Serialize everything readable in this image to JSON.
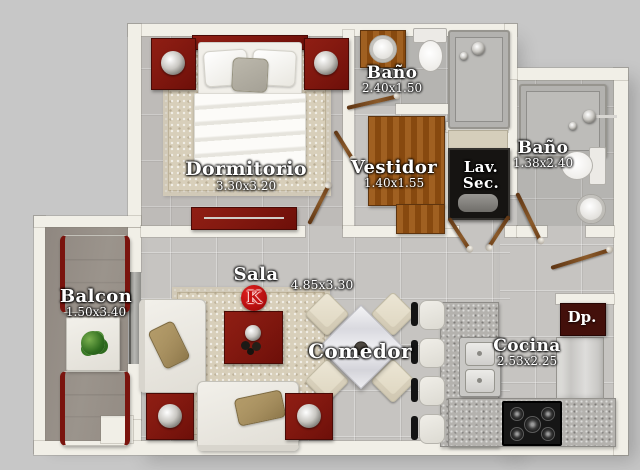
{
  "logo": {
    "letter": "K"
  },
  "rooms": {
    "dormitorio": {
      "label": "Dormitorio",
      "dims": "3.30x3.20"
    },
    "bano_top": {
      "label": "Baño",
      "dims": "2.40x1.50"
    },
    "vestidor": {
      "label": "Vestidor",
      "dims": "1.40x1.55"
    },
    "lav_sec": {
      "line1": "Lav.",
      "line2": "Sec."
    },
    "bano_right": {
      "label": "Baño",
      "dims": "1.38x2.40"
    },
    "balcon": {
      "label": "Balcon",
      "dims": "1.50x3.40"
    },
    "sala": {
      "label": "Sala"
    },
    "sala_comedor": {
      "dims": "4.85x3.30"
    },
    "comedor": {
      "label": "Comedor"
    },
    "cocina": {
      "label": "Cocina",
      "dims": "2.53x2.25"
    },
    "despensa": {
      "label": "Dp."
    }
  },
  "colors": {
    "background": "#c7c7c7",
    "wall": "#f1efe7",
    "floor": "#c6c4c1",
    "balcony_floor": "#979088",
    "furniture_red": "#7e150f",
    "logo_red": "#c01010",
    "wood": "#8a5016",
    "rug": "#d8cfba",
    "granite": "#b4b2ae",
    "laundry_dark": "#161412",
    "despensa_red": "#43100b"
  }
}
